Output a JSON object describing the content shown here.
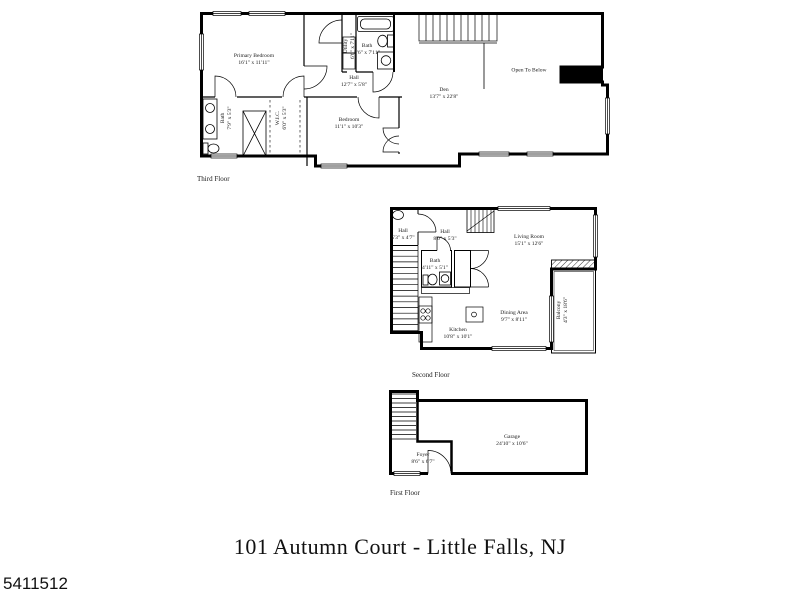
{
  "page": {
    "title": "101 Autumn Court - Little Falls, NJ",
    "photo_id": "5411512",
    "colors": {
      "walls": "#000000",
      "background": "#ffffff",
      "text": "#1a1a1a"
    }
  },
  "floors": {
    "third": {
      "caption": "Third Floor",
      "rooms": {
        "primary_bedroom": {
          "name": "Primary Bedroom",
          "dims": "16'1\" x 11'11\""
        },
        "utility": {
          "name": "Utility",
          "dims": "6'6\" x 7'11\""
        },
        "bath_top": {
          "name": "Bath",
          "dims": "5'6\" x 7'11\""
        },
        "hall": {
          "name": "Hall",
          "dims": "12'7\" x 5'8\""
        },
        "den": {
          "name": "Den",
          "dims": "13'7\" x 22'8\""
        },
        "open_to_below": {
          "name": "Open To Below"
        },
        "bath_left": {
          "name": "Bath",
          "dims": "7'9\" x 5'3\""
        },
        "wic": {
          "name": "W.I.C.",
          "dims": "6'0\" x 5'3\""
        },
        "bedroom": {
          "name": "Bedroom",
          "dims": "11'1\" x 10'3\""
        }
      }
    },
    "second": {
      "caption": "Second Floor",
      "rooms": {
        "hall_small": {
          "name": "Hall",
          "dims": "5'3\" x 4'7\""
        },
        "hall": {
          "name": "Hall",
          "dims": "8'0\" x 5'3\""
        },
        "living_room": {
          "name": "Living Room",
          "dims": "15'1\" x 12'6\""
        },
        "bath": {
          "name": "Bath",
          "dims": "4'11\" x 5'1\""
        },
        "kitchen": {
          "name": "Kitchen",
          "dims": "10'8\" x 10'1\""
        },
        "dining_area": {
          "name": "Dining Area",
          "dims": "9'7\" x 8'11\""
        },
        "balcony": {
          "name": "Balcony",
          "dims": "4'3\" x 18'6\""
        }
      }
    },
    "first": {
      "caption": "First Floor",
      "rooms": {
        "foyer": {
          "name": "Foyer",
          "dims": "8'6\" x 6'7\""
        },
        "garage": {
          "name": "Garage",
          "dims": "24'10\" x 10'6\""
        }
      }
    }
  }
}
